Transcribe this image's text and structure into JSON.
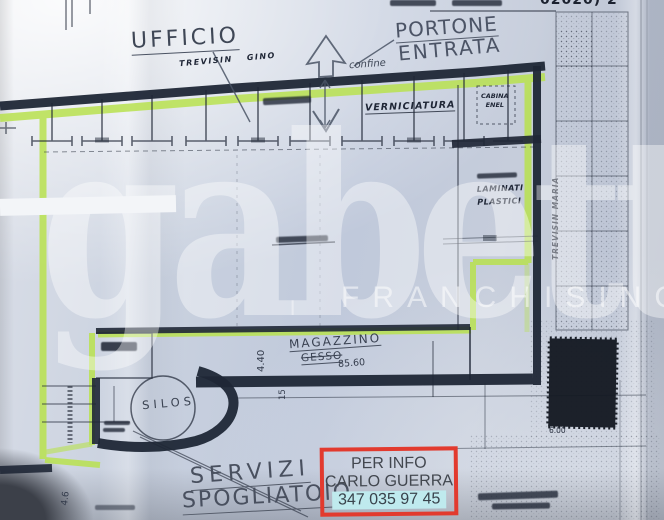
{
  "photo": {
    "top_fragment": "02020) 2",
    "watermark": {
      "brand": "gabetti",
      "subtitle": "FRANCHISING"
    }
  },
  "plan": {
    "rooms": {
      "ufficio": "UFFICIO",
      "portone_line1": "PORTONE",
      "portone_line2": "ENTRATA",
      "verniciatura": "VERNICIATURA",
      "cabina_enel_line1": "CABINA",
      "cabina_enel_line2": "ENEL",
      "laminati_line1": "LAMINATI",
      "laminati_line2": "PLASTICI",
      "magazzino": "MAGAZZINO",
      "gesso": "GESSO",
      "silos": "SILOS",
      "servizi": "SERVIZI",
      "spogliatoio": "SPOGLIATOIO"
    },
    "names": {
      "trevisin_gino": "TREVISIN GINO",
      "trevisin_maria": "TREVISIN MARIA"
    },
    "annotations": {
      "confine": "confine"
    },
    "dimensions": {
      "d_440": "4.40",
      "d_8560": "85.60",
      "d_15": "15",
      "d_600": "6.00",
      "d_46": "4.6"
    }
  },
  "info_box": {
    "line1": "PER INFO",
    "line2": "CARLO GUERRA",
    "phone": "347 035 97 45"
  },
  "colors": {
    "highlighter_green": "#b9e24f",
    "info_border_red": "#e23a2e",
    "phone_highlight_cyan": "#bfeaee",
    "ink": "#1f2736"
  }
}
